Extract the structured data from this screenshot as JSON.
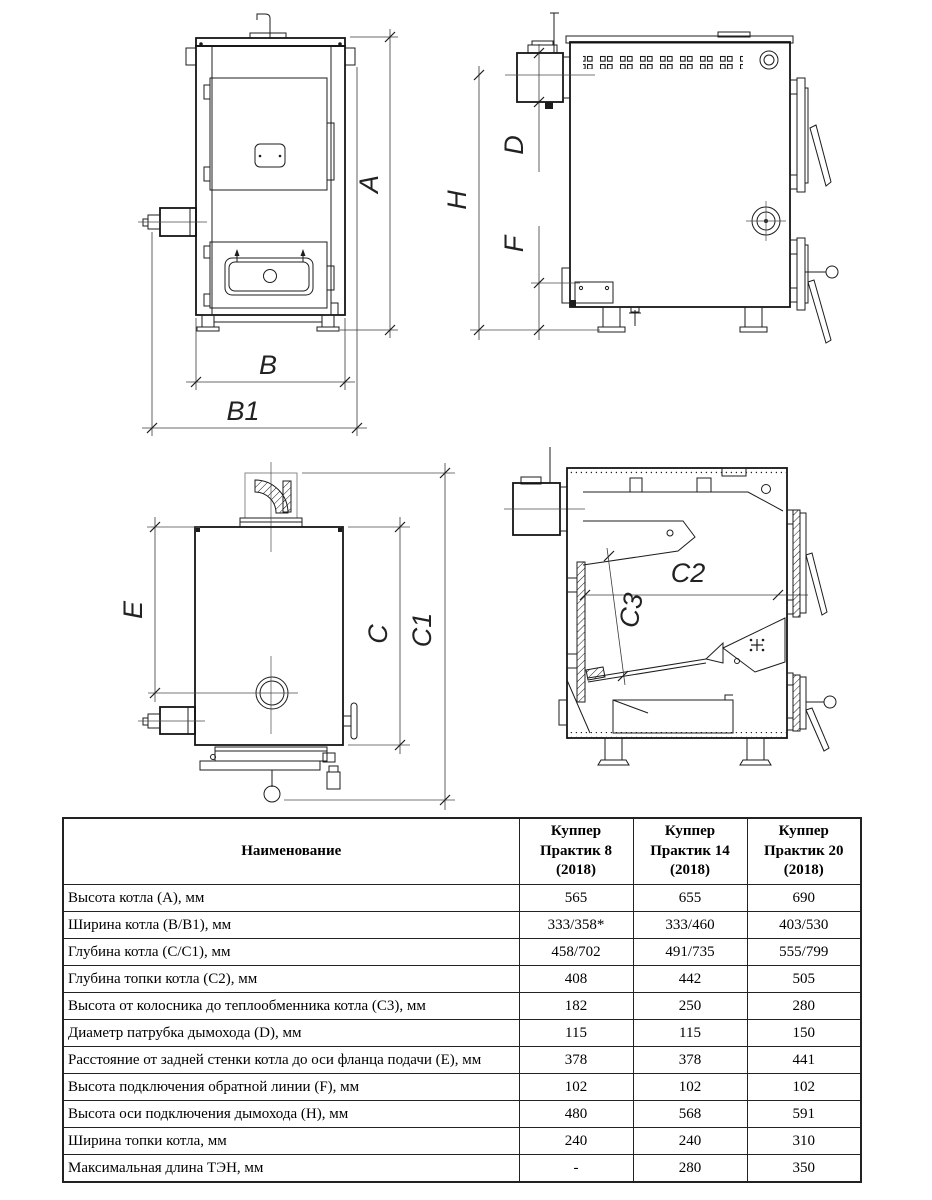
{
  "dims": {
    "A": "A",
    "B": "B",
    "B1": "B1",
    "H": "H",
    "D": "D",
    "F": "F",
    "E": "E",
    "C": "C",
    "C1": "C1",
    "C2": "C2",
    "C3": "C3"
  },
  "table": {
    "header": {
      "name": "Наименование",
      "models": [
        "Куппер Практик 8 (2018)",
        "Куппер Практик 14 (2018)",
        "Куппер Практик 20 (2018)"
      ]
    },
    "rows": [
      {
        "name": "Высота котла (А), мм",
        "v8": "565",
        "v14": "655",
        "v20": "690"
      },
      {
        "name": "Ширина котла (В/В1), мм",
        "v8": "333/358*",
        "v14": "333/460",
        "v20": "403/530"
      },
      {
        "name": "Глубина котла (С/С1), мм",
        "v8": "458/702",
        "v14": "491/735",
        "v20": "555/799"
      },
      {
        "name": "Глубина топки котла (С2), мм",
        "v8": "408",
        "v14": "442",
        "v20": "505"
      },
      {
        "name": "Высота от колосника до теплообменника котла (С3), мм",
        "v8": "182",
        "v14": "250",
        "v20": "280"
      },
      {
        "name": "Диаметр патрубка дымохода (D), мм",
        "v8": "115",
        "v14": "115",
        "v20": "150"
      },
      {
        "name": "Расстояние от задней стенки котла до оси фланца подачи (Е), мм",
        "v8": "378",
        "v14": "378",
        "v20": "441"
      },
      {
        "name": "Высота подключения обратной линии (F), мм",
        "v8": "102",
        "v14": "102",
        "v20": "102"
      },
      {
        "name": "Высота оси подключения дымохода (Н), мм",
        "v8": "480",
        "v14": "568",
        "v20": "591"
      },
      {
        "name": "Ширина топки котла, мм",
        "v8": "240",
        "v14": "240",
        "v20": "310"
      },
      {
        "name": "Максимальная длина ТЭН, мм",
        "v8": "-",
        "v14": "280",
        "v20": "350"
      }
    ]
  }
}
